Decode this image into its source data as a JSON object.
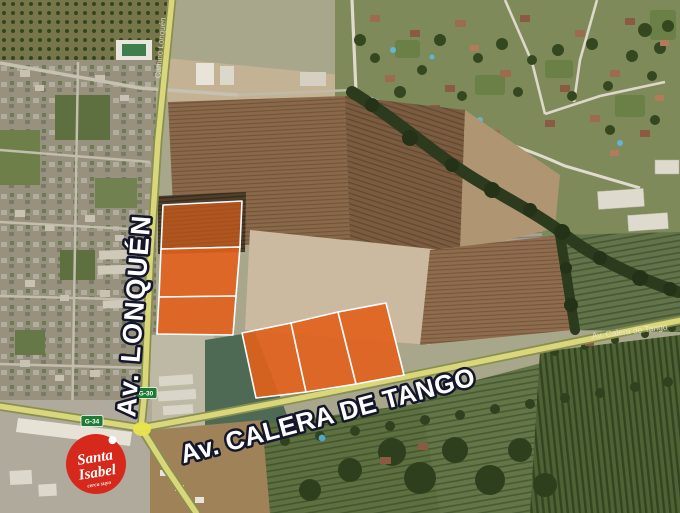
{
  "map": {
    "kind": "satellite-imagery-with-overlays",
    "labels": {
      "lonquen": "Av. LONQUÉN",
      "calera": "Av. CALERA DE TANGO",
      "calera_small": "Av. Calera de Tango",
      "lonquen_small": "Camino Lonquén"
    },
    "shields": {
      "g30": "G-30",
      "g34": "G-34",
      "color": "#1e7a34"
    },
    "logo": {
      "brand": "Santa Isabel",
      "line1": "Santa",
      "line2": "Isabel",
      "tagline": "cerca suyo",
      "bg": "#d7281c"
    },
    "highlight": {
      "fill": "#e2611b",
      "stroke": "#ffffff",
      "groups": [
        {
          "name": "north-strip-along-lonquen",
          "parcels": 3
        },
        {
          "name": "south-block-along-calera-de-tango",
          "parcels": 3
        }
      ]
    }
  }
}
